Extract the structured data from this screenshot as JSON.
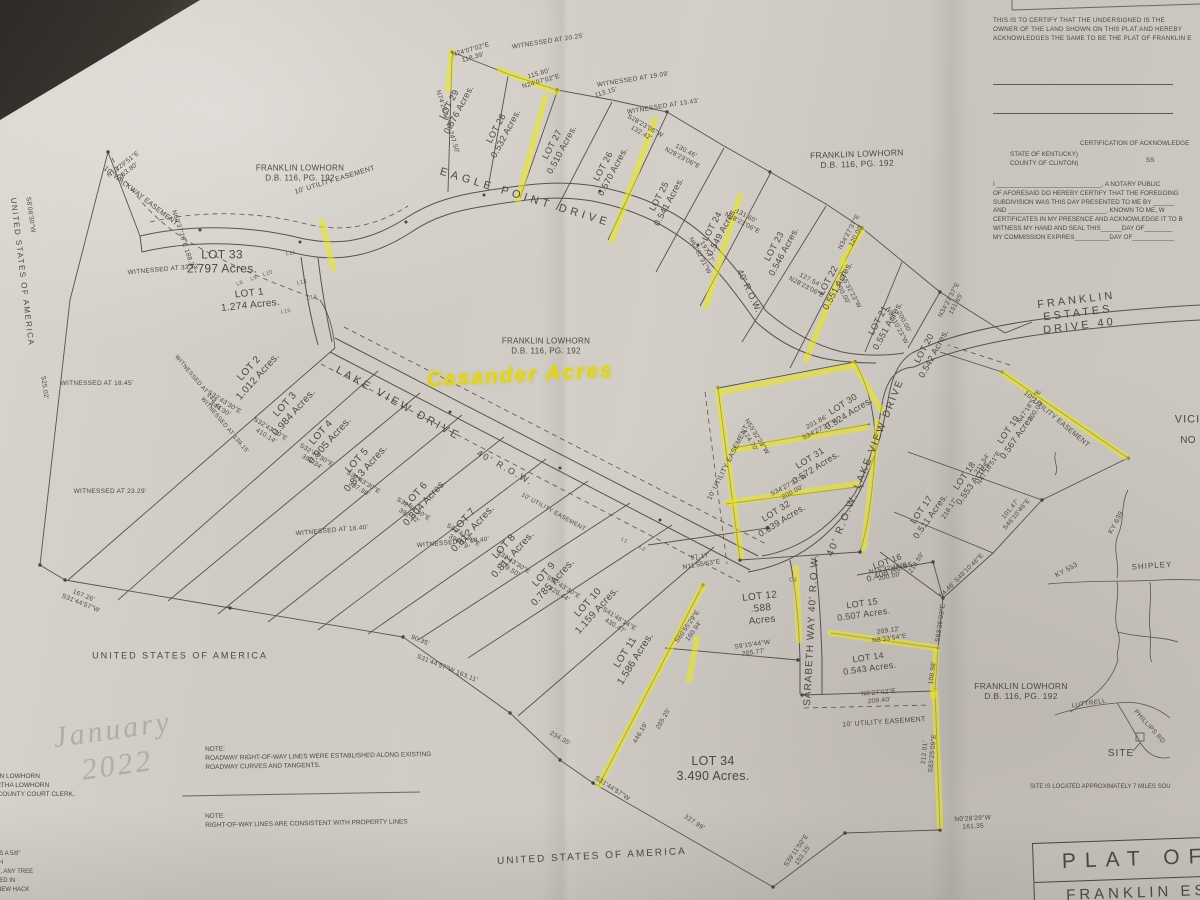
{
  "handwriting": {
    "note": "Casander Acres"
  },
  "watermark": "January\n2022",
  "certifications": {
    "owner_block": "THIS IS TO CERTIFY THAT THE UNDERSIGNED IS THE\nOWNER OF THE LAND SHOWN ON THIS PLAT AND HEREBY\nACKNOWLEDGES THE SAME TO BE THE PLAT OF FRANKLIN E",
    "ack_header": "CERTIFICATION OF ACKNOWLEDGE",
    "state_county": "STATE OF KENTUCKY)\nCOUNTY OF CLINTON)",
    "ss": "SS",
    "notary_block": "I ______________________________, A NOTARY PUBLIC\nOF AFORESAID DO HEREBY CERTIFY THAT THE FOREGOING\nSUBDIVISION WAS THIS DAY PRESENTED TO ME BY ______\nAND ____________________________, KNOWN TO ME, W\nCERTIFICATES IN MY PRESENCE AND ACKNOWLEDGE IT TO B\nWITNESS MY HAND AND SEAL THIS______DAY OF________\nMY COMMISSION EXPIRES__________DAY OF____________"
  },
  "notes": {
    "note1": "NOTE:\nROADWAY RIGHT-OF-WAY LINES WERE ESTABLISHED ALONG EXISTING\nROADWAY CURVES AND TANGENTS.",
    "note2": "NOTE:\nRIGHT-OF-WAY LINES ARE CONSISTENT WITH PROPERTY LINES",
    "clerk_block": "FRANKLIN LOWHORN\nAND BERTHA LOWHORN\nOF THE COUNTY COURT CLERK,",
    "corner_block": "S IS A 5/8\"\n5TH\nED, ANY TREE\nATED IN\n3 NEW HACK",
    "site_note": "SITE IS LOCATED APPROXIMATELY 7 MILES SOU"
  },
  "title_block": {
    "line1": "PLAT OF",
    "line2": "FRANKLIN ES"
  },
  "adjoiners": {
    "owner_label": "FRANKLIN LOWHORN\nD.B. 116, PG. 192",
    "usa_label": "UNITED STATES OF AMERICA"
  },
  "roads": {
    "eagle_point": "EAGLE POINT DRIVE",
    "lake_view": "LAKE VIEW DRIVE",
    "lake_view_row": "40' R.O.W.",
    "lake_view_vert": "40' R.O.W. LAKE VIEW DRIVE",
    "franklin_estates": "FRANKLIN ESTATES DRIVE  40",
    "sarabeth": "SARABETH WAY 40' R.O.W.",
    "connector_row": "40' R.O.W."
  },
  "easements": {
    "walkway": "10' WALKWAY EASEMENT",
    "utility": "10' UTILITY EASEMENT"
  },
  "vicinity": {
    "title1": "VICINITY",
    "title2": "NO",
    "shipley": "SHIPLEY",
    "ky639": "KY 639",
    "ky553": "KY 553",
    "luttrell": "LUTTRELL",
    "phillips": "PHILLIPS RD",
    "site": "SITE"
  },
  "lots": [
    {
      "label": "LOT 1",
      "acres": "1.274  Acres."
    },
    {
      "label": "LOT 2",
      "acres": "1.012  Acres."
    },
    {
      "label": "LOT 3",
      "acres": "0.984  Acres."
    },
    {
      "label": "LOT 4",
      "acres": "0.905  Acres."
    },
    {
      "label": "LOT 5",
      "acres": "0.813  Acres."
    },
    {
      "label": "LOT 6",
      "acres": "0.804  Acres."
    },
    {
      "label": "LOT 7",
      "acres": "0.812  Acres."
    },
    {
      "label": "LOT 8",
      "acres": "0.811  Acres."
    },
    {
      "label": "LOT 9",
      "acres": "0.785  Acres."
    },
    {
      "label": "LOT 10",
      "acres": "1.159  Acres."
    },
    {
      "label": "LOT 11",
      "acres": "1.586  Acres."
    },
    {
      "label": "LOT 12",
      "acres": ".588\nAcres"
    },
    {
      "label": "LOT 14",
      "acres": "0.543  Acres."
    },
    {
      "label": "LOT 15",
      "acres": "0.507  Acres."
    },
    {
      "label": "LOT 16",
      "acres": "0.408  Acres."
    },
    {
      "label": "LOT 17",
      "acres": "0.511  Acres."
    },
    {
      "label": "LOT 18",
      "acres": "0.553  Acres."
    },
    {
      "label": "LOT 19",
      "acres": "0.567  Acres."
    },
    {
      "label": "LOT 20",
      "acres": "0.542  Acres."
    },
    {
      "label": "LOT 21",
      "acres": "0.551  Acres."
    },
    {
      "label": "LOT 22",
      "acres": "0.551  Acres."
    },
    {
      "label": "LOT 23",
      "acres": "0.546  Acres."
    },
    {
      "label": "LOT 24",
      "acres": "0.549  Acres."
    },
    {
      "label": "LOT 25",
      "acres": "0.541  Acres."
    },
    {
      "label": "LOT 26",
      "acres": "0.570  Acres."
    },
    {
      "label": "LOT 27",
      "acres": "0.510  Acres."
    },
    {
      "label": "LOT 28",
      "acres": "0.532  Acres."
    },
    {
      "label": "LOT 29",
      "acres": "0.576  Acres."
    },
    {
      "label": "LOT 30",
      "acres": "0.524  Acres."
    },
    {
      "label": "LOT 31",
      "acres": "0.572  Acres."
    },
    {
      "label": "LOT 32",
      "acres": "0.639  Acres."
    },
    {
      "label": "LOT 33",
      "acres": "2.797  Acres."
    },
    {
      "label": "LOT 34",
      "acres": "3.490  Acres."
    }
  ],
  "bearings": [
    "N13'29'51\"E\n263.80'",
    "S8'06'30\"W",
    "525.02'",
    "167.26'\nS31'44'57\"W",
    "N74'24'19\"W 247.50'",
    "N24'07'02\"E\n118.39'",
    "115.80'\nN24'07'02\"E",
    "113.15'",
    "S28'23'06\"W\n132.42'",
    "130.46'\nN28'23'06\"E",
    "131.60'\nN28'23'06\"E",
    "127.54'\nN28'23'06\"E",
    "N34'27'37\"E\n120.00'",
    "N34'27'37\"E\n151.65'",
    "N55'32'23\"W\n200.00'",
    "200.00'\nN55'10'23\"W",
    "S32'43'30\"E\n444.30'",
    "S32'43'30\"E\n410.14'",
    "S32'43'30\"E\n399.34'",
    "S32'43'30\"E\n387.90'",
    "S32'43'30\"E\n392.32'",
    "S32'43'30\"E\n396.79'",
    "S32'43'30\"E\n409.50'",
    "S32'43'30\"E\n426.44'",
    "S41'46'14\"E\n430.47'",
    "90.35'",
    "S31'44'57\"W  163.11'",
    "234.35'",
    "327.99'",
    "S31'44'57\"W",
    "S39'11'50\"E\n153.15'",
    "N0'28'29\"W\n161.35",
    "212.01'\nS83'25'09\"E",
    "446.19'",
    "285.25'",
    "97.17'\nN11'56'53\"E",
    "S60'55'29\"E\n160.94'",
    "S9'15'44\"W\n205.77'",
    "209.12'\nN8'33'54\"E",
    "N6'27'02\"E\n209.40'",
    "N15'32'45\"E\n200.00'",
    "N47'18'51\"E\n200.00'",
    "211.54'\nN47'18'51\"E",
    "201.86'\nS34'27'37\"W",
    "S34'27'37\"W\n200.00'",
    "N55'32'23\"W\n124.70'",
    "S83'25'03\"E",
    "108.98'",
    "54.46'  S48'10'46\"E",
    "N60'37'26\"E  188.37'",
    "218.17'",
    "213.59'",
    "101.47'\nS46'10'46\"E",
    "197.77'\nN62'02'31\"W"
  ],
  "witnessed": [
    "WITNESSED AT 20.25'",
    "WITNESSED AT 19.09'",
    "WITNESSED AT 13.43'",
    "WITNESSED AT 33.72'",
    "WITNESSED AT 148.41'",
    "WITNESSED AT 139.15'",
    "WITNESSED AT 18.45'",
    "WITNESSED AT 23.29'",
    "WITNESSED AT 16.40'",
    "WITNESSED AT 18.40'"
  ],
  "line_labels": [
    "L8",
    "L9",
    "L10",
    "L11",
    "L13",
    "L14",
    "L15",
    "L1",
    "L2",
    "C3"
  ],
  "colors": {
    "ink": "#57524b",
    "highlight": "#ece81e",
    "paper": "#cfcac3"
  }
}
